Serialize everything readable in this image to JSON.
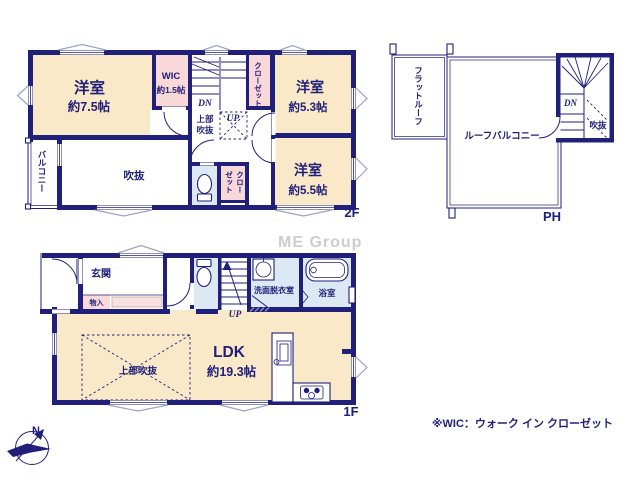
{
  "page": {
    "watermark": "ME Group",
    "note": "※WIC：ウォーク イン クローゼット",
    "compass_north": "N"
  },
  "colors": {
    "wall_navy": "#20207a",
    "room_cream": "#f9e9c9",
    "closet_pink": "#f8d8d8",
    "counter_pink": "#f7e2e0",
    "wet_area_blue": "#dce8f4",
    "window_slate": "#9aa3c8",
    "watermark_gray": "#cdcdcd"
  },
  "floor_2f": {
    "label": "2F",
    "rooms": {
      "bedroom_a": {
        "name": "洋室",
        "size": "約7.5帖"
      },
      "wic": {
        "name": "WIC",
        "size": "約1.5帖"
      },
      "bedroom_b": {
        "name": "洋室",
        "size": "約5.3帖"
      },
      "bedroom_c": {
        "name": "洋室",
        "size": "約5.5帖"
      },
      "void": "吹抜",
      "balcony": "バルコニー",
      "closet_hall": "クローゼット",
      "closet_c_line1": "クロー",
      "closet_c_line2": "ゼット",
      "upper_void_line1": "上部",
      "upper_void_line2": "吹抜"
    },
    "stairs": {
      "down": "DN",
      "up": "UP"
    }
  },
  "floor_1f": {
    "label": "1F",
    "rooms": {
      "entrance": "玄関",
      "storage": "物入",
      "ldk": {
        "name": "LDK",
        "size": "約19.3帖"
      },
      "upper_void": "上部吹抜",
      "washroom": "洗面脱衣室",
      "bathroom": "浴室"
    },
    "stairs": {
      "up": "UP"
    }
  },
  "penthouse": {
    "label": "PH",
    "rooms": {
      "flat_roof": "フラットルーフ",
      "roof_balcony": "ルーフバルコニー",
      "void": "吹抜"
    },
    "stairs": {
      "down": "DN"
    }
  }
}
